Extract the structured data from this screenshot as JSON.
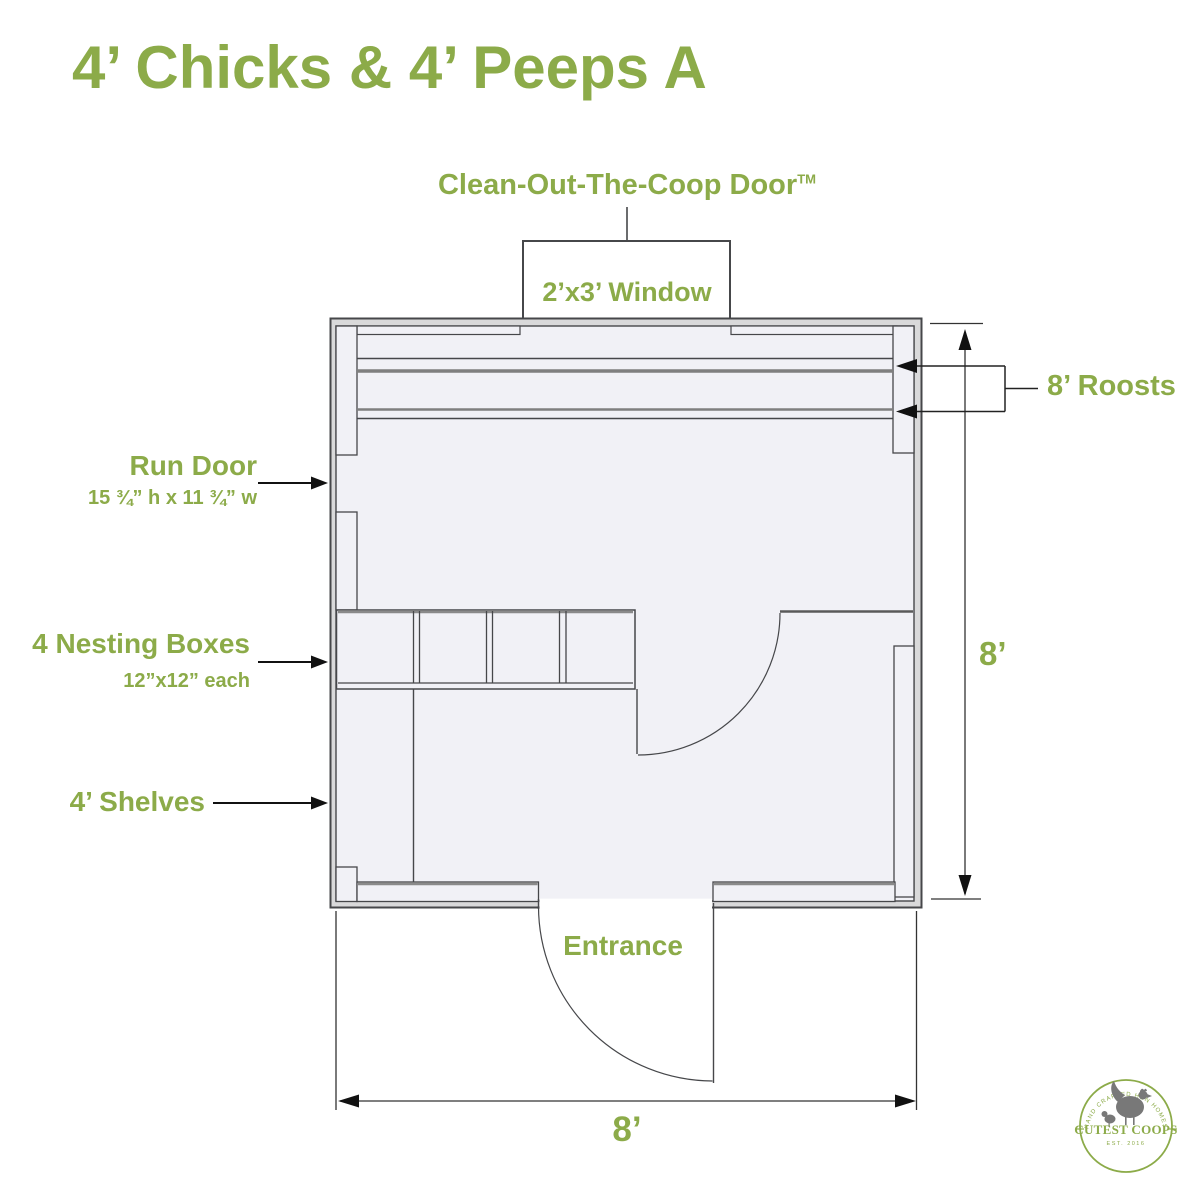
{
  "title": "4’ Chicks & 4’ Peeps A",
  "labels": {
    "clean_out_door": "Clean-Out-The-Coop Door",
    "clean_out_door_tm": "TM",
    "window": "2’x3’ Window",
    "roosts": "8’ Roosts",
    "run_door_title": "Run Door",
    "run_door_spec": "15 ¾” h x 11 ¾” w",
    "nesting_title": "4 Nesting Boxes",
    "nesting_spec": "12”x12” each",
    "shelves": "4’ Shelves",
    "entrance": "Entrance"
  },
  "dimensions": {
    "width_label": "8’",
    "height_label": "8’"
  },
  "plan": {
    "coop_size": "8 ft x 8 ft",
    "nesting_box_count": 4,
    "roost_count": 2
  },
  "logo": {
    "name": "CUTEST COOPS",
    "tagline": "HAND CRAFTED HEN HOMES",
    "est": "EST. 2016"
  },
  "colors": {
    "accent_green": "#8cab49",
    "wall_fill": "#d9d9da",
    "interior_fill": "#f1f1f6",
    "line": "#46474a",
    "roost_gray": "#7f7f7f"
  }
}
